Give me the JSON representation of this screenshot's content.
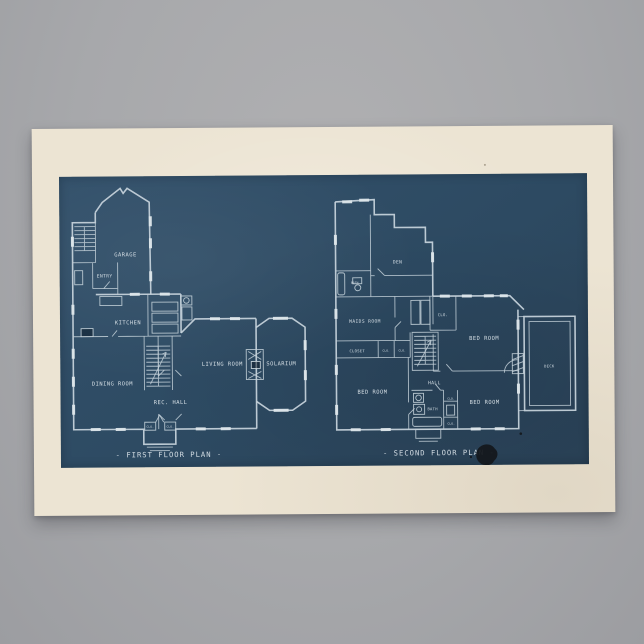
{
  "palette": {
    "backdrop": "#a7a8ab",
    "paper": "#ece4d3",
    "blueprint": "#2d4a62",
    "line": "#c9d5dd",
    "ink": "#d9e2e8"
  },
  "first_floor": {
    "title": "- FIRST FLOOR PLAN -",
    "garage": "GARAGE",
    "entry": "ENTRY",
    "kitchen": "KITCHEN",
    "dining_room": "DINING ROOM",
    "rec_hall": "REC. HALL",
    "living_room": "LIVING ROOM",
    "solarium": "SOLARIUM",
    "closet_left": "CLO.",
    "closet_right": "CLO."
  },
  "second_floor": {
    "title": "- SECOND FLOOR PLAN -",
    "den": "DEN",
    "bath_upper": "BATH",
    "maids_room": "MAIDS ROOM",
    "closet_upper": "CLO.",
    "closet": "CLOSET",
    "clo_a": "CLO.",
    "clo_b": "CLO.",
    "bed_room_ne": "BED ROOM",
    "hall": "HALL",
    "bed_room_w": "BED ROOM",
    "bath": "BATH",
    "bed_room_se": "BED ROOM",
    "deck": "DECK",
    "clo_c": "CLO.",
    "clo_d": "CLO."
  }
}
